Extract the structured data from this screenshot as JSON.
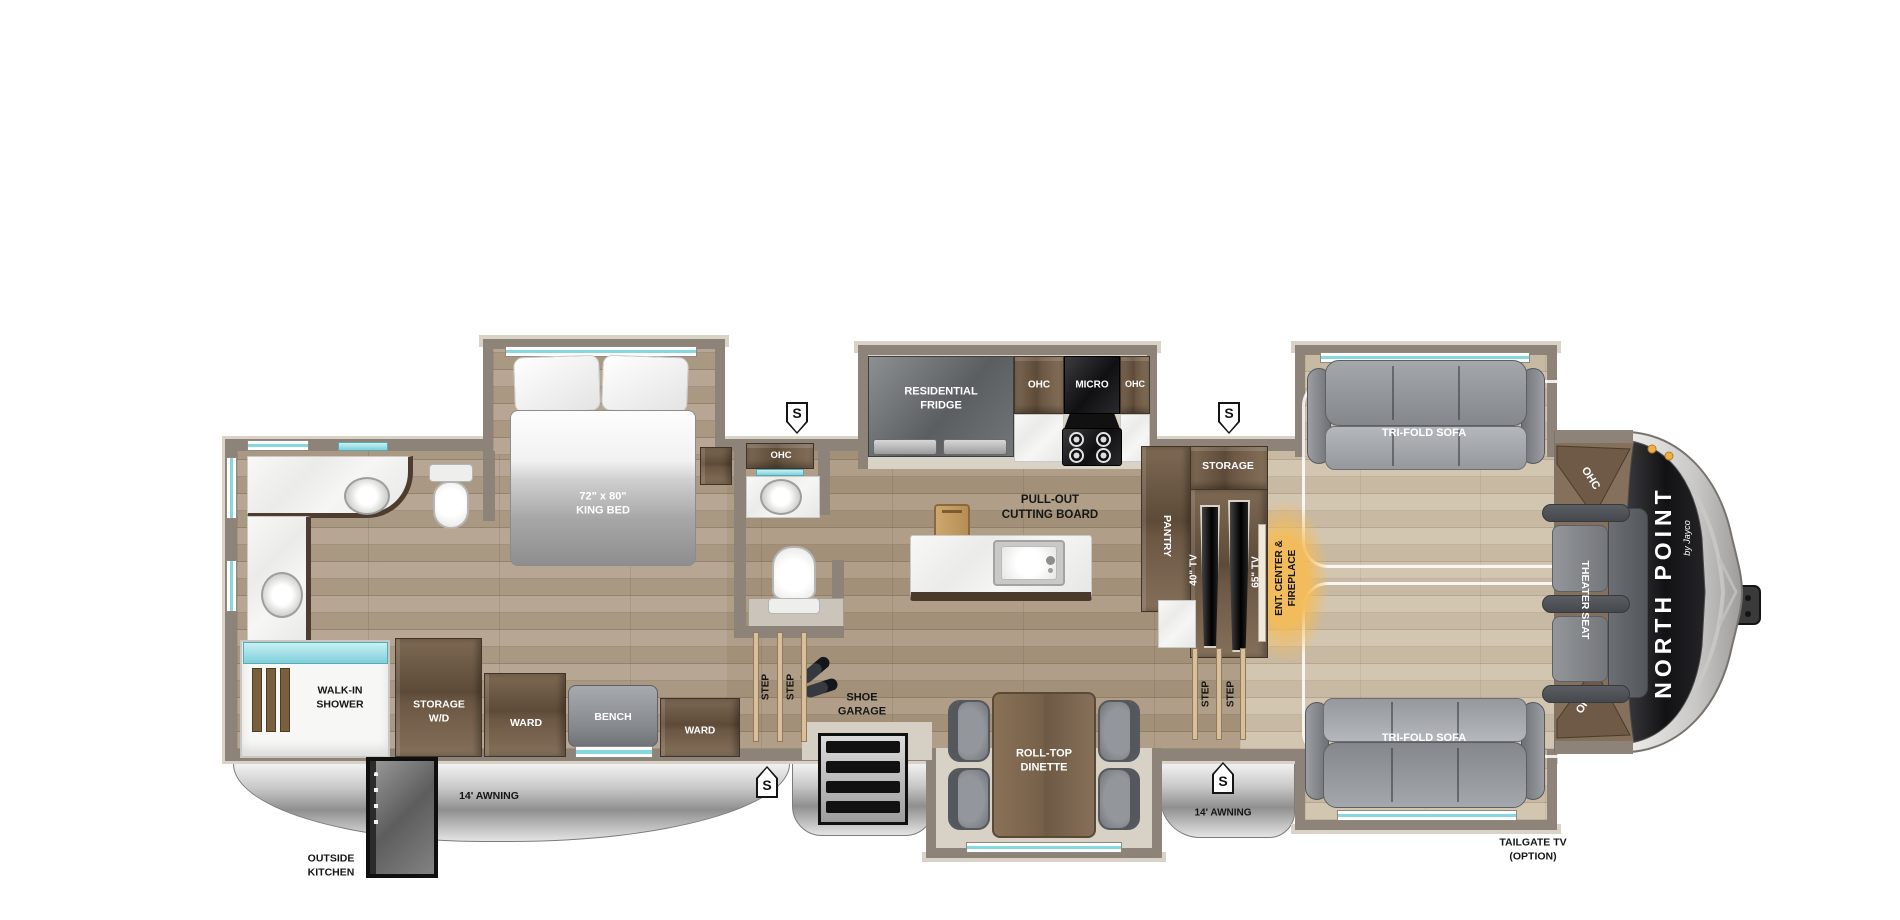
{
  "branding": {
    "model": "NORTH POINT",
    "brand_sub": "by Jayco"
  },
  "bedroom": {
    "bed_size": "72\" x 80\"",
    "bed_name": "KING BED"
  },
  "bathroom": {
    "ohc": "OHC",
    "shower_l1": "WALK-IN",
    "shower_l2": "SHOWER"
  },
  "wardrobe": {
    "storage_l1": "STORAGE",
    "storage_l2": "W/D",
    "ward_front": "WARD",
    "bench": "BENCH",
    "ward_rear": "WARD"
  },
  "kitchen": {
    "fridge_l1": "RESIDENTIAL",
    "fridge_l2": "FRIDGE",
    "ohc_left": "OHC",
    "micro": "MICRO",
    "ohc_right": "OHC",
    "cutting_l1": "PULL-OUT",
    "cutting_l2": "CUTTING BOARD"
  },
  "entry": {
    "step": "STEP",
    "shoe_l1": "SHOE",
    "shoe_l2": "GARAGE",
    "dinette_l1": "ROLL-TOP",
    "dinette_l2": "DINETTE"
  },
  "media_wall": {
    "storage": "STORAGE",
    "pantry": "PANTRY",
    "tv_40": "40\" TV",
    "tv_65": "65\" TV",
    "ent_l1": "ENT. CENTER &",
    "ent_l2": "FIREPLACE"
  },
  "living": {
    "sofa_top": "TRI-FOLD SOFA",
    "sofa_bottom": "TRI-FOLD SOFA",
    "theater_seat": "THEATER SEAT",
    "ohc_front_top": "OHC",
    "ohc_front_bottom": "OHC",
    "step": "STEP"
  },
  "exterior": {
    "awning_left": "14' AWNING",
    "awning_right": "14' AWNING",
    "outside_l1": "OUTSIDE",
    "outside_l2": "KITCHEN",
    "tailgate_l1": "TAILGATE TV",
    "tailgate_l2": "(OPTION)",
    "s_marker": "S"
  },
  "colors": {
    "floor": "#b2a18c",
    "raised_floor": "#d0c2ab",
    "wall": "#8d8379",
    "wall_trim": "#d9d2c7",
    "cabinet_wood": "#6e5a46",
    "window_teal": "#86d7e0",
    "fireplace_glow": "#f3bd62",
    "awning_silver": "#c9c9c9",
    "furniture_gray": "#8f9397",
    "appliance_black": "#141414"
  }
}
